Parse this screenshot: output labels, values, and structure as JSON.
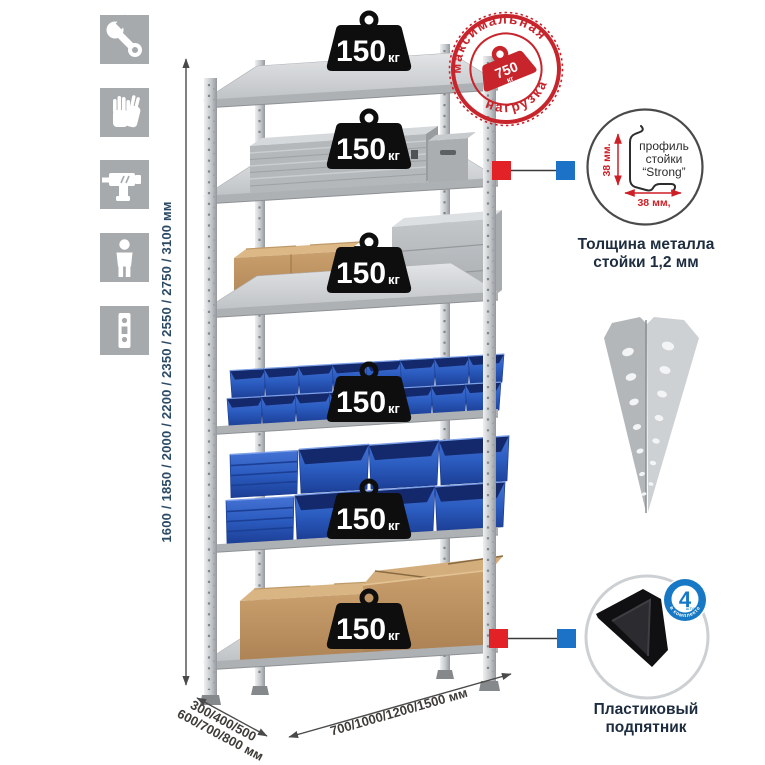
{
  "colors": {
    "background": "#ffffff",
    "icon_tile": "#a7aaac",
    "metal_light": "#dfe1e3",
    "metal_dark": "#94989c",
    "bin_blue": "#2b5cc0",
    "cardboard": "#c49c6a",
    "badge_black": "#0e0e0f",
    "stamp_red": "#c8242b",
    "marker_red": "#e32228",
    "marker_blue": "#1c72c6",
    "foot_badge_blue": "#1779c5"
  },
  "icons": [
    {
      "name": "wrench-icon"
    },
    {
      "name": "gloves-icon"
    },
    {
      "name": "drill-icon"
    },
    {
      "name": "person-icon"
    },
    {
      "name": "upright-profile-icon"
    }
  ],
  "height_dimension": {
    "label": "1600 / 1850 / 2000 / 2200 / 2350 / 2550 / 2750 / 3100 мм"
  },
  "depth_dimension": {
    "line1": "300/400/500",
    "line2": "600/700/800 мм"
  },
  "width_dimension": {
    "label": "700/1000/1200/1500 мм"
  },
  "rack": {
    "shelves": [
      {
        "load": "150",
        "unit": "кг"
      },
      {
        "load": "150",
        "unit": "кг"
      },
      {
        "load": "150",
        "unit": "кг"
      },
      {
        "load": "150",
        "unit": "кг"
      },
      {
        "load": "150",
        "unit": "кг"
      },
      {
        "load": "150",
        "unit": "кг"
      }
    ]
  },
  "max_load_stamp": {
    "top_arc": "максимальная",
    "bottom_arc": "нагрузка",
    "value": "750",
    "unit": "кг"
  },
  "profile_detail": {
    "line1": "профиль",
    "line2": "стойки",
    "line3": "“Strong”",
    "vertical_dim": "38 мм.",
    "horizontal_dim": "38 мм,",
    "caption1": "Толщина металла",
    "caption2": "стойки 1,2 мм"
  },
  "foot_detail": {
    "badge_number": "4",
    "badge_small": "штуки",
    "badge_arc": "в комплекте",
    "caption1": "Пластиковый",
    "caption2": "подпятник"
  }
}
